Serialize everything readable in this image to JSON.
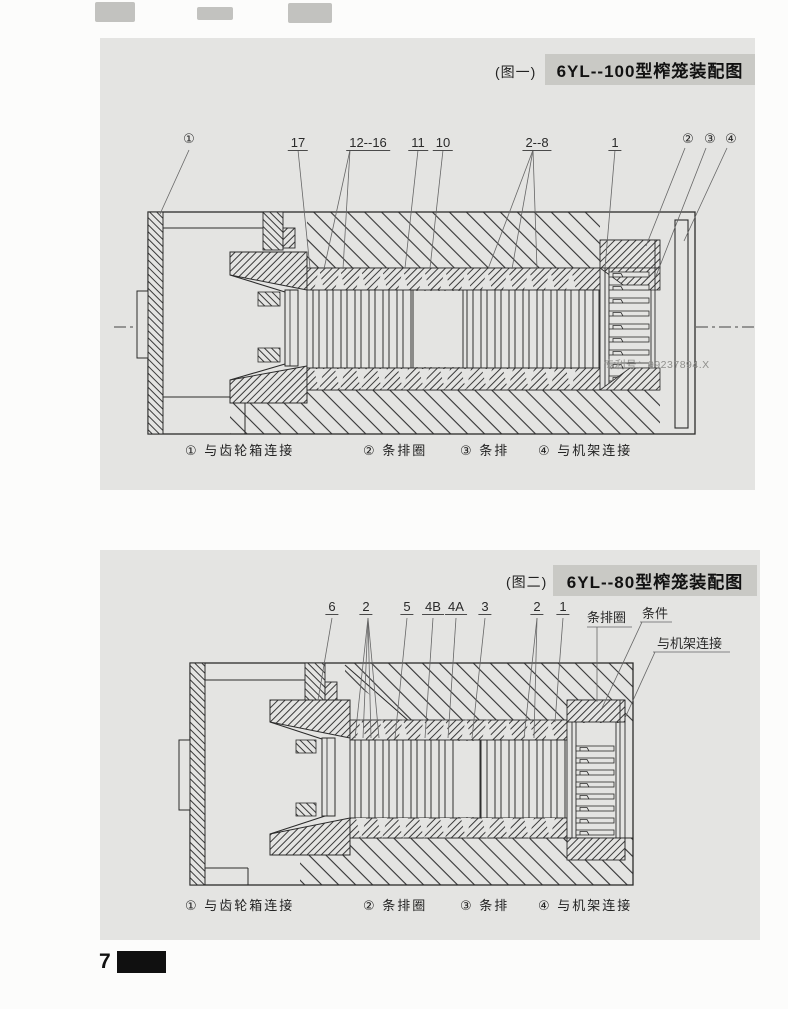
{
  "figure1": {
    "tag": "(图一)",
    "title": "6YL--100型榨笼装配图",
    "callouts": [
      "①",
      "17",
      "12--16",
      "11",
      "10",
      "2--8",
      "1",
      "②",
      "③",
      "④"
    ],
    "watermark": "专利号：99237894.X",
    "legend": [
      "① 与齿轮箱连接",
      "② 条排圈",
      "③ 条排",
      "④ 与机架连接"
    ]
  },
  "figure2": {
    "tag": "(图二)",
    "title": "6YL--80型榨笼装配图",
    "callouts": [
      "6",
      "2",
      "5",
      "4B",
      "4A",
      "3",
      "2",
      "1"
    ],
    "side_labels": [
      "条排圈",
      "条件",
      "与机架连接"
    ],
    "legend": [
      "① 与齿轮箱连接",
      "② 条排圈",
      "③ 条排",
      "④ 与机架连接"
    ]
  },
  "page": {
    "number": "7"
  }
}
